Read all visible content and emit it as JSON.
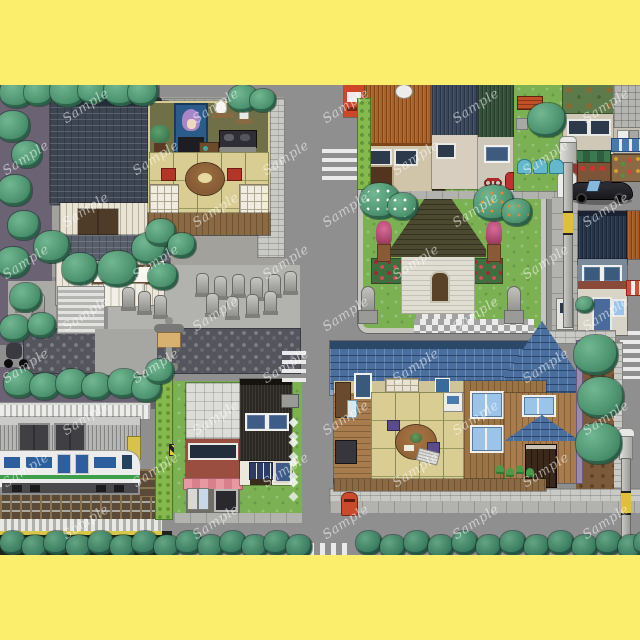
{
  "canvas": {
    "width": 640,
    "height": 640,
    "border_color": "#fbee6d",
    "road_color": "#8f8f8f",
    "map_top": 85,
    "map_height": 470
  },
  "watermark": {
    "text": "Sample",
    "color": "rgba(255,255,255,0.55)",
    "positions": [
      [
        60,
        14
      ],
      [
        190,
        14
      ],
      [
        320,
        14
      ],
      [
        450,
        14
      ],
      [
        580,
        14
      ],
      [
        0,
        66
      ],
      [
        130,
        66
      ],
      [
        260,
        66
      ],
      [
        390,
        66
      ],
      [
        520,
        66
      ],
      [
        60,
        118
      ],
      [
        190,
        118
      ],
      [
        320,
        118
      ],
      [
        450,
        118
      ],
      [
        580,
        118
      ],
      [
        0,
        170
      ],
      [
        130,
        170
      ],
      [
        260,
        170
      ],
      [
        390,
        170
      ],
      [
        520,
        170
      ],
      [
        60,
        222
      ],
      [
        190,
        222
      ],
      [
        320,
        222
      ],
      [
        450,
        222
      ],
      [
        580,
        222
      ],
      [
        0,
        274
      ],
      [
        130,
        274
      ],
      [
        260,
        274
      ],
      [
        390,
        274
      ],
      [
        520,
        274
      ],
      [
        60,
        326
      ],
      [
        190,
        326
      ],
      [
        320,
        326
      ],
      [
        450,
        326
      ],
      [
        580,
        326
      ],
      [
        0,
        378
      ],
      [
        130,
        378
      ],
      [
        260,
        378
      ],
      [
        390,
        378
      ],
      [
        520,
        378
      ],
      [
        60,
        430
      ],
      [
        190,
        430
      ],
      [
        320,
        430
      ],
      [
        450,
        430
      ],
      [
        580,
        430
      ]
    ]
  },
  "temple": {
    "sign_text": "庵日寿"
  },
  "palette": {
    "grass": "#7cb153",
    "tree_dark": "#2e6b52",
    "tree_mid": "#4e9470",
    "temple_roof": "#3d4452",
    "church_roof": "#4b4930",
    "blue_roof": "#4a6f9e",
    "tatami": "#d9cd93",
    "train_stripe": "#3f9e4c",
    "train_window": "#2d5f9e",
    "crosswalk_white": "#eaeaea",
    "pole_band_yellow": "#e0c038",
    "postbox_red": "#cc4a2c",
    "awning_pink": "#e898a2",
    "awning_blue": "#4878b0",
    "awning_green": "#3c7850",
    "bench_blue": "#64b8cc",
    "vending_red": "#cc4628",
    "car_black": "#17171c"
  },
  "decor": {
    "trees": [
      [
        0,
        -8,
        34
      ],
      [
        24,
        -6,
        30
      ],
      [
        50,
        -10,
        36
      ],
      [
        78,
        -8,
        30
      ],
      [
        104,
        -10,
        34
      ],
      [
        128,
        -6,
        30
      ],
      [
        228,
        0,
        30
      ],
      [
        250,
        4,
        26
      ],
      [
        -4,
        26,
        34
      ],
      [
        12,
        56,
        30
      ],
      [
        -2,
        90,
        34
      ],
      [
        8,
        126,
        32
      ],
      [
        -4,
        162,
        34
      ],
      [
        10,
        198,
        32
      ],
      [
        0,
        230,
        30
      ],
      [
        28,
        228,
        28
      ],
      [
        34,
        146,
        36
      ],
      [
        62,
        168,
        36
      ],
      [
        98,
        166,
        40
      ],
      [
        132,
        148,
        34
      ],
      [
        148,
        178,
        30
      ],
      [
        146,
        134,
        30
      ],
      [
        168,
        148,
        28
      ],
      [
        4,
        284,
        32
      ],
      [
        30,
        288,
        30
      ],
      [
        56,
        284,
        32
      ],
      [
        82,
        288,
        30
      ],
      [
        108,
        284,
        32
      ],
      [
        132,
        290,
        30
      ],
      [
        146,
        274,
        28
      ],
      [
        528,
        18,
        38
      ],
      [
        360,
        98,
        40,
        "blossom"
      ],
      [
        388,
        108,
        30,
        "blossom"
      ],
      [
        474,
        100,
        40,
        "fruit"
      ],
      [
        502,
        114,
        30,
        "fruit"
      ],
      [
        574,
        250,
        44
      ],
      [
        578,
        292,
        46
      ],
      [
        576,
        338,
        46
      ],
      [
        576,
        212,
        18
      ]
    ],
    "trees_bottom": [
      [
        0,
        446
      ],
      [
        22,
        450
      ],
      [
        44,
        446
      ],
      [
        66,
        450
      ],
      [
        88,
        446
      ],
      [
        110,
        450
      ],
      [
        132,
        446
      ],
      [
        154,
        450
      ],
      [
        176,
        446
      ],
      [
        198,
        450
      ],
      [
        220,
        446
      ],
      [
        242,
        450
      ],
      [
        264,
        446
      ],
      [
        286,
        450
      ],
      [
        356,
        446
      ],
      [
        380,
        450
      ],
      [
        404,
        446
      ],
      [
        428,
        450
      ],
      [
        452,
        446
      ],
      [
        476,
        450
      ],
      [
        500,
        446
      ],
      [
        524,
        450
      ],
      [
        548,
        446
      ],
      [
        572,
        450
      ],
      [
        596,
        446
      ],
      [
        618,
        450
      ],
      [
        634,
        446
      ]
    ],
    "statues": [
      [
        196,
        188
      ],
      [
        214,
        191
      ],
      [
        232,
        189
      ],
      [
        250,
        192
      ],
      [
        268,
        189
      ],
      [
        284,
        186
      ],
      [
        206,
        208
      ],
      [
        226,
        211
      ],
      [
        246,
        209
      ],
      [
        264,
        206
      ],
      [
        122,
        202
      ],
      [
        138,
        206
      ],
      [
        154,
        210
      ],
      [
        16,
        204
      ],
      [
        32,
        208
      ]
    ],
    "benches": [
      [
        517,
        74
      ],
      [
        533,
        74
      ],
      [
        549,
        74
      ]
    ],
    "tufts": [
      [
        496,
        380
      ],
      [
        506,
        383
      ],
      [
        516,
        380
      ],
      [
        526,
        383
      ]
    ],
    "stepping_stones": [
      [
        290,
        334
      ],
      [
        290,
        354
      ],
      [
        290,
        374
      ],
      [
        290,
        394
      ]
    ]
  }
}
